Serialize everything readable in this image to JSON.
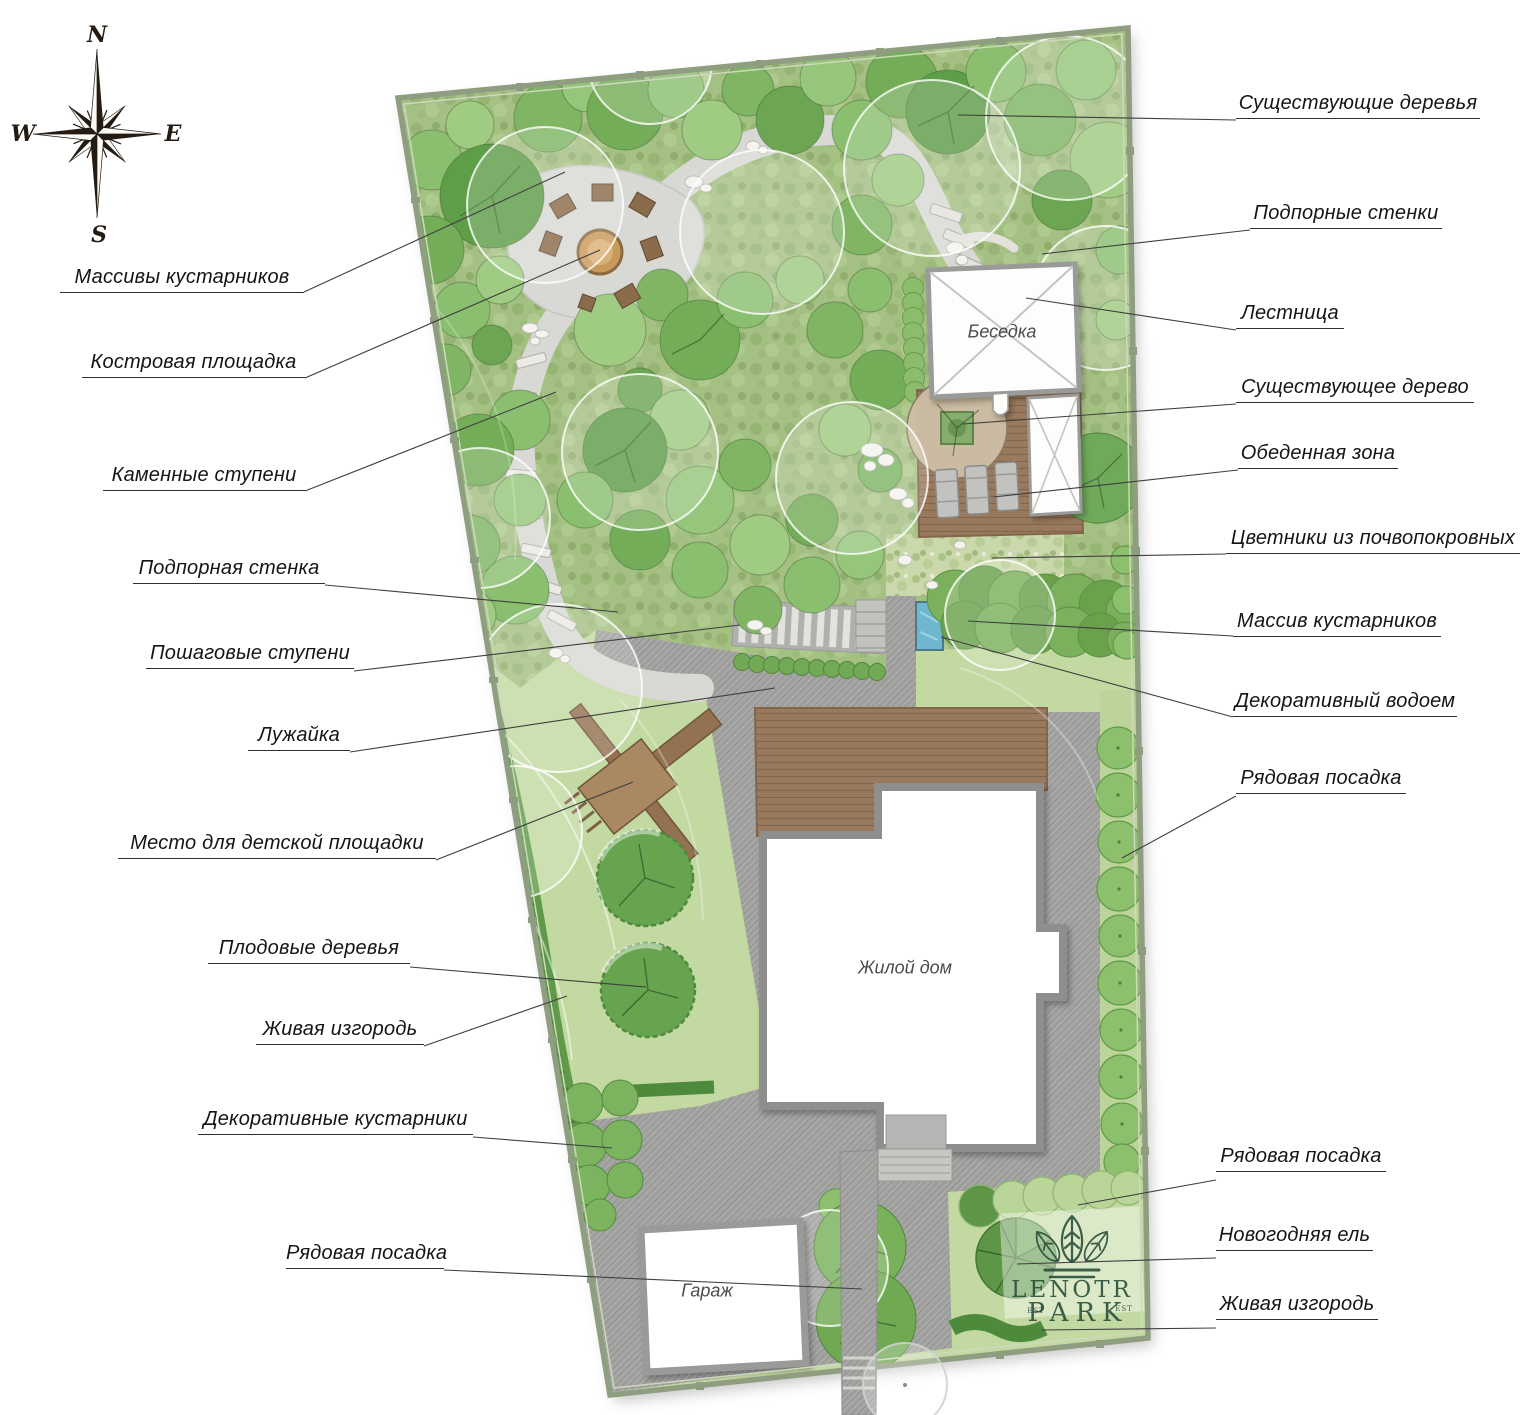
{
  "compass": {
    "n": "N",
    "e": "E",
    "s": "S",
    "w": "W"
  },
  "callouts": {
    "left": [
      {
        "label": "Массивы кустарников"
      },
      {
        "label": "Костровая площадка"
      },
      {
        "label": "Каменные ступени"
      },
      {
        "label": "Подпорная стенка"
      },
      {
        "label": "Пошаговые ступени"
      },
      {
        "label": "Лужайка"
      },
      {
        "label": "Место для детской площадки"
      },
      {
        "label": "Плодовые деревья"
      },
      {
        "label": "Живая изгородь"
      },
      {
        "label": "Декоративные кустарники"
      },
      {
        "label": "Рядовая посадка"
      }
    ],
    "right": [
      {
        "label": "Существующие деревья"
      },
      {
        "label": "Подпорные стенки"
      },
      {
        "label": "Лестница"
      },
      {
        "label": "Существующее дерево"
      },
      {
        "label": "Обеденная зона"
      },
      {
        "label": "Цветники из почвопокровных"
      },
      {
        "label": "Массив кустарников"
      },
      {
        "label": "Декоративный водоем"
      },
      {
        "label": "Рядовая посадка"
      },
      {
        "label": "Рядовая посадка"
      },
      {
        "label": "Новогодняя ель"
      },
      {
        "label": "Живая изгородь"
      }
    ]
  },
  "plan": {
    "gazebo": "Беседка",
    "house": "Жилой дом",
    "garage": "Гараж"
  },
  "logo": {
    "name_line1": "LENOTR",
    "name_line2": "PARK",
    "est": "EST"
  },
  "colors": {
    "forest_green": "#a4c083",
    "lawn_green": "#c3d9a2",
    "paving_gray": "#a6a6a4",
    "deck_brown": "#9a7a5e",
    "water_blue": "#6fb7cf",
    "hedge_green": "#5f9a49",
    "logo_green": "#2e5540"
  }
}
